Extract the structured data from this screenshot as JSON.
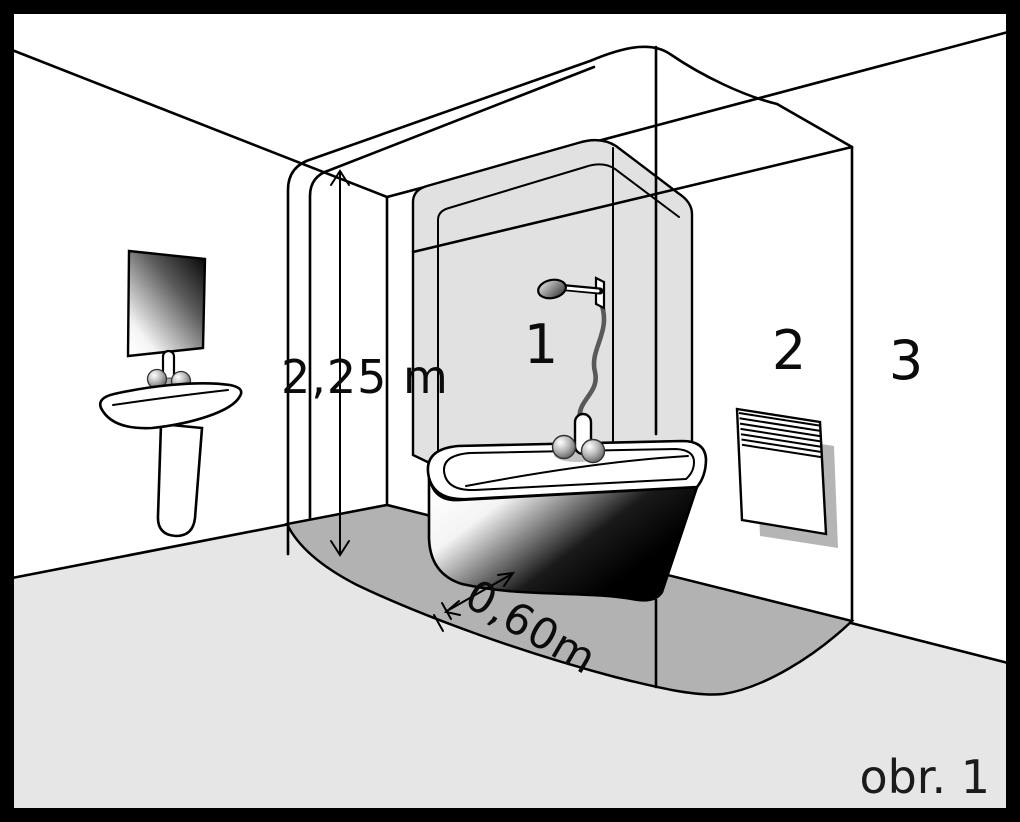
{
  "figure_caption": "obr. 1",
  "zone_labels": {
    "zone1": "1",
    "zone2": "2",
    "zone3": "3"
  },
  "dimension_labels": {
    "ceiling_height": "2,25 m",
    "zone_distance": "0,60m"
  },
  "palette": {
    "outline": "#000000",
    "wall": "#ffffff",
    "floor": "#e6e6e6",
    "protection_zone_floor": "#b2b2b2",
    "shower_glass": "#e1e1e1",
    "frame": "#000000"
  },
  "fixtures": [
    "bathtub",
    "shower-head",
    "shower-hose",
    "mixer-tap",
    "washbasin-with-pedestal",
    "mirror",
    "wall-heater"
  ]
}
